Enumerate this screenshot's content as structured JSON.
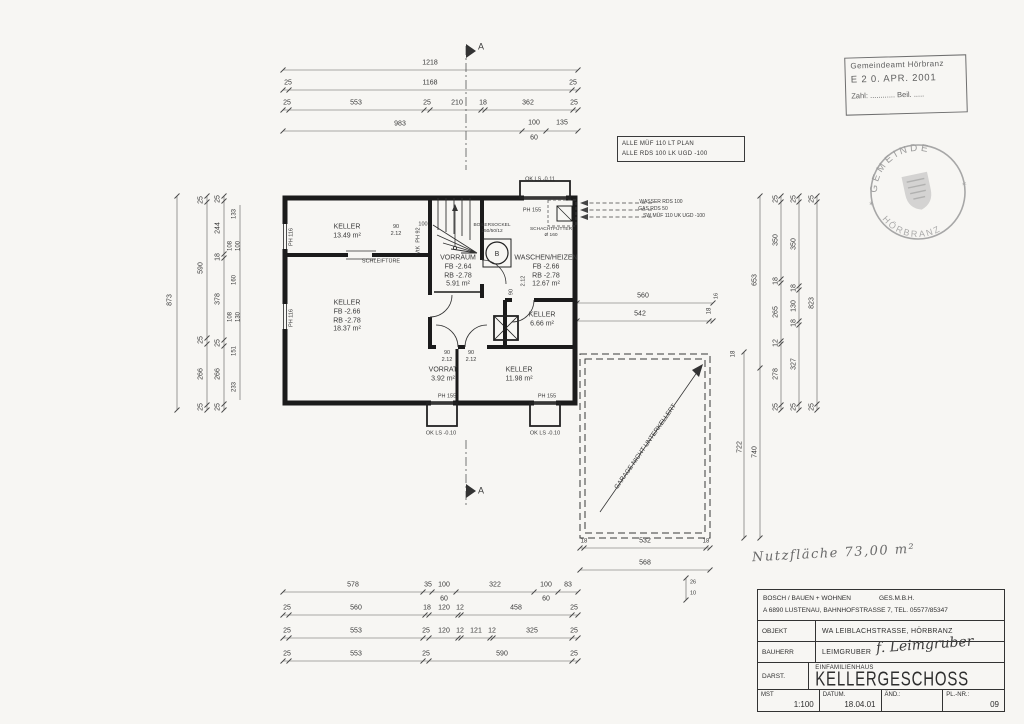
{
  "meta": {
    "paper": "#f7f6f3",
    "ink": "#333333"
  },
  "stamp": {
    "line1": "Gemeindeamt Hörbranz",
    "line2": "E   2 0. APR. 2001",
    "line3": "Zahl: ............  Beil. ....."
  },
  "seal": {
    "top": "GEMEINDE",
    "bottom": "HÖRBRANZ",
    "star_left": "✶",
    "star_right": "✶"
  },
  "note_box": {
    "line1": "ALLE MÜF 110 LT PLAN",
    "line2": "ALLE RDS 100 LK UGD -100"
  },
  "handwriting": {
    "note": "Nutzfläche  73,00 m²"
  },
  "title_block": {
    "company": "BOSCH / BAUEN + WOHNEN",
    "company2": "GES.M.B.H.",
    "address": "A 6890  LUSTENAU, BAHNHOFSTRASSE 7,   TEL. 05577/85347",
    "objekt_label": "OBJEKT",
    "objekt": "WA LEIBLACHSTRASSE, HÖRBRANZ",
    "bauherr_label": "BAUHERR",
    "bauherr": "LEIMGRUBER",
    "signature": "f. Leimgruber",
    "darst_label": "DARST.",
    "darst_small": "EINFAMILIENHAUS",
    "darst_big": "KELLERGESCHOSS",
    "mst_label": "MST",
    "mst": "1:100",
    "datum_label": "DATUM.",
    "datum": "18.04.01",
    "aend_label": "ÄND.:",
    "plnr_label": "PL.-NR.:",
    "plnr": "09"
  },
  "plan": {
    "labels": [
      {
        "t": "1218",
        "x": 430,
        "y": 64
      },
      {
        "t": "25",
        "x": 288,
        "y": 84
      },
      {
        "t": "1168",
        "x": 430,
        "y": 84
      },
      {
        "t": "25",
        "x": 573,
        "y": 84
      },
      {
        "t": "25",
        "x": 287,
        "y": 104
      },
      {
        "t": "553",
        "x": 356,
        "y": 104
      },
      {
        "t": "25",
        "x": 427,
        "y": 104
      },
      {
        "t": "210",
        "x": 457,
        "y": 104
      },
      {
        "t": "18",
        "x": 483,
        "y": 104
      },
      {
        "t": "362",
        "x": 528,
        "y": 104
      },
      {
        "t": "25",
        "x": 574,
        "y": 104
      },
      {
        "t": "983",
        "x": 400,
        "y": 125
      },
      {
        "t": "100",
        "x": 534,
        "y": 124
      },
      {
        "t": "60",
        "x": 534,
        "y": 139
      },
      {
        "t": "135",
        "x": 562,
        "y": 124
      },
      {
        "t": "A",
        "x": 481,
        "y": 47,
        "s": 9,
        "n": "section-marker-a"
      },
      {
        "t": "873",
        "x": 171,
        "y": 300,
        "r": -90
      },
      {
        "t": "25",
        "x": 202,
        "y": 200,
        "r": -90
      },
      {
        "t": "590",
        "x": 202,
        "y": 268,
        "r": -90
      },
      {
        "t": "25",
        "x": 202,
        "y": 340,
        "r": -90
      },
      {
        "t": "266",
        "x": 202,
        "y": 374,
        "r": -90
      },
      {
        "t": "25",
        "x": 202,
        "y": 407,
        "r": -90
      },
      {
        "t": "25",
        "x": 219,
        "y": 199,
        "r": -90
      },
      {
        "t": "244",
        "x": 219,
        "y": 228,
        "r": -90
      },
      {
        "t": "18",
        "x": 219,
        "y": 257,
        "r": -90
      },
      {
        "t": "378",
        "x": 219,
        "y": 299,
        "r": -90
      },
      {
        "t": "25",
        "x": 219,
        "y": 343,
        "r": -90
      },
      {
        "t": "266",
        "x": 219,
        "y": 374,
        "r": -90
      },
      {
        "t": "25",
        "x": 219,
        "y": 407,
        "r": -90
      },
      {
        "t": "133",
        "x": 235,
        "y": 214,
        "r": -90,
        "s": 6
      },
      {
        "t": "108",
        "x": 231,
        "y": 246,
        "r": -90,
        "s": 6
      },
      {
        "t": "100",
        "x": 239,
        "y": 246,
        "r": -90,
        "s": 6
      },
      {
        "t": "160",
        "x": 235,
        "y": 280,
        "r": -90,
        "s": 6
      },
      {
        "t": "108",
        "x": 231,
        "y": 317,
        "r": -90,
        "s": 6
      },
      {
        "t": "130",
        "x": 239,
        "y": 317,
        "r": -90,
        "s": 6
      },
      {
        "t": "151",
        "x": 235,
        "y": 351,
        "r": -90,
        "s": 6
      },
      {
        "t": "233",
        "x": 235,
        "y": 387,
        "r": -90,
        "s": 6
      },
      {
        "t": "653",
        "x": 756,
        "y": 280,
        "r": -90
      },
      {
        "t": "740",
        "x": 756,
        "y": 452,
        "r": -90
      },
      {
        "t": "722",
        "x": 741,
        "y": 447,
        "r": -90
      },
      {
        "t": "25",
        "x": 777,
        "y": 199,
        "r": -90
      },
      {
        "t": "350",
        "x": 777,
        "y": 240,
        "r": -90
      },
      {
        "t": "18",
        "x": 777,
        "y": 281,
        "r": -90
      },
      {
        "t": "265",
        "x": 777,
        "y": 312,
        "r": -90
      },
      {
        "t": "12",
        "x": 777,
        "y": 343,
        "r": -90
      },
      {
        "t": "278",
        "x": 777,
        "y": 374,
        "r": -90
      },
      {
        "t": "25",
        "x": 777,
        "y": 407,
        "r": -90
      },
      {
        "t": "25",
        "x": 795,
        "y": 199,
        "r": -90
      },
      {
        "t": "350",
        "x": 795,
        "y": 244,
        "r": -90
      },
      {
        "t": "18",
        "x": 795,
        "y": 288,
        "r": -90
      },
      {
        "t": "130",
        "x": 795,
        "y": 306,
        "r": -90
      },
      {
        "t": "18",
        "x": 795,
        "y": 323,
        "r": -90
      },
      {
        "t": "327",
        "x": 795,
        "y": 364,
        "r": -90
      },
      {
        "t": "25",
        "x": 795,
        "y": 407,
        "r": -90
      },
      {
        "t": "25",
        "x": 813,
        "y": 199,
        "r": -90
      },
      {
        "t": "823",
        "x": 813,
        "y": 303,
        "r": -90
      },
      {
        "t": "25",
        "x": 813,
        "y": 407,
        "r": -90
      },
      {
        "t": "18",
        "x": 734,
        "y": 354,
        "r": -90,
        "s": 6
      },
      {
        "t": "560",
        "x": 643,
        "y": 297
      },
      {
        "t": "542",
        "x": 640,
        "y": 315
      },
      {
        "t": "18",
        "x": 710,
        "y": 311,
        "r": -90,
        "s": 6
      },
      {
        "t": "16",
        "x": 717,
        "y": 296,
        "r": -90,
        "s": 5.5
      },
      {
        "t": "GARAGE NICHT UNTERKELLERT",
        "x": 646,
        "y": 447,
        "r": -55,
        "s": 6.5,
        "n": "garage-note"
      },
      {
        "t": "18",
        "x": 584,
        "y": 542,
        "s": 6
      },
      {
        "t": "532",
        "x": 645,
        "y": 542
      },
      {
        "t": "18",
        "x": 706,
        "y": 542,
        "s": 6
      },
      {
        "t": "568",
        "x": 645,
        "y": 564
      },
      {
        "t": "26",
        "x": 693,
        "y": 583,
        "s": 5.5
      },
      {
        "t": "10",
        "x": 693,
        "y": 594,
        "s": 5.5
      },
      {
        "t": "578",
        "x": 353,
        "y": 586
      },
      {
        "t": "35",
        "x": 428,
        "y": 586
      },
      {
        "t": "100",
        "x": 444,
        "y": 586
      },
      {
        "t": "60",
        "x": 444,
        "y": 600
      },
      {
        "t": "322",
        "x": 495,
        "y": 586
      },
      {
        "t": "100",
        "x": 546,
        "y": 586
      },
      {
        "t": "60",
        "x": 546,
        "y": 600
      },
      {
        "t": "83",
        "x": 568,
        "y": 586
      },
      {
        "t": "25",
        "x": 287,
        "y": 609
      },
      {
        "t": "560",
        "x": 356,
        "y": 609
      },
      {
        "t": "18",
        "x": 427,
        "y": 609
      },
      {
        "t": "120",
        "x": 444,
        "y": 609
      },
      {
        "t": "12",
        "x": 460,
        "y": 609
      },
      {
        "t": "458",
        "x": 516,
        "y": 609
      },
      {
        "t": "25",
        "x": 574,
        "y": 609
      },
      {
        "t": "25",
        "x": 287,
        "y": 632
      },
      {
        "t": "553",
        "x": 356,
        "y": 632
      },
      {
        "t": "25",
        "x": 426,
        "y": 632
      },
      {
        "t": "120",
        "x": 444,
        "y": 632
      },
      {
        "t": "12",
        "x": 460,
        "y": 632
      },
      {
        "t": "121",
        "x": 476,
        "y": 632
      },
      {
        "t": "12",
        "x": 492,
        "y": 632
      },
      {
        "t": "325",
        "x": 532,
        "y": 632
      },
      {
        "t": "25",
        "x": 574,
        "y": 632
      },
      {
        "t": "25",
        "x": 287,
        "y": 655
      },
      {
        "t": "553",
        "x": 356,
        "y": 655
      },
      {
        "t": "25",
        "x": 426,
        "y": 655
      },
      {
        "t": "590",
        "x": 502,
        "y": 655
      },
      {
        "t": "25",
        "x": 574,
        "y": 655
      },
      {
        "t": "A",
        "x": 481,
        "y": 491,
        "s": 9,
        "n": "section-marker-a"
      },
      {
        "t": "KELLER\n13.49 m²",
        "x": 347,
        "y": 232,
        "s": 7,
        "n": "room-label-keller-1349"
      },
      {
        "t": "KELLER\nFB -2.66\nRB -2.78\n18.37 m²",
        "x": 347,
        "y": 317,
        "s": 7,
        "n": "room-label-keller-1837"
      },
      {
        "t": "VORRAUM\nFB -2.64\nRB -2.78\n5.91 m²",
        "x": 458,
        "y": 272,
        "s": 7,
        "n": "room-label-vorraum"
      },
      {
        "t": "WASCHEN/HEIZEN\nFB -2.66\nRB -2.78\n12.67 m²",
        "x": 546,
        "y": 272,
        "s": 7,
        "n": "room-label-waschen-heizen"
      },
      {
        "t": "KELLER\n6.66 m²",
        "x": 542,
        "y": 320,
        "s": 7,
        "n": "room-label-keller-666"
      },
      {
        "t": "KELLER\n11.98 m²",
        "x": 519,
        "y": 375,
        "s": 7,
        "n": "room-label-keller-1198"
      },
      {
        "t": "VORRAT\n3.92 m²",
        "x": 443,
        "y": 375,
        "s": 7,
        "n": "room-label-vorrat"
      },
      {
        "t": "OK LS -0.11",
        "x": 540,
        "y": 180,
        "s": 5.5
      },
      {
        "t": "PH 155",
        "x": 532,
        "y": 211,
        "s": 5.5
      },
      {
        "t": "PH 155",
        "x": 447,
        "y": 397,
        "s": 5.5
      },
      {
        "t": "PH 155",
        "x": 547,
        "y": 397,
        "s": 5.5
      },
      {
        "t": "OK LS -0.10",
        "x": 441,
        "y": 434,
        "s": 5.5
      },
      {
        "t": "OK LS -0.10",
        "x": 545,
        "y": 434,
        "s": 5.5
      },
      {
        "t": "PH 116",
        "x": 292,
        "y": 237,
        "r": -90,
        "s": 5.5
      },
      {
        "t": "PH 116",
        "x": 292,
        "y": 318,
        "r": -90,
        "s": 5.5
      },
      {
        "t": "VtK  PH 92",
        "x": 419,
        "y": 241,
        "r": -90,
        "s": 5.5
      },
      {
        "t": "SCHLEIFTÜRE",
        "x": 381,
        "y": 262,
        "s": 5.5
      },
      {
        "t": "90\n2.12",
        "x": 396,
        "y": 231,
        "s": 5.5
      },
      {
        "t": "100",
        "x": 423,
        "y": 225,
        "s": 5.5
      },
      {
        "t": "BOILERSOCKEL\n150/50/12",
        "x": 492,
        "y": 229,
        "s": 4.8
      },
      {
        "t": "SCHACHTFUTTER\nØ 160",
        "x": 551,
        "y": 233,
        "s": 4.8
      },
      {
        "t": "2.12",
        "x": 524,
        "y": 281,
        "r": -90,
        "s": 5.5
      },
      {
        "t": "90",
        "x": 512,
        "y": 292,
        "r": -90,
        "s": 5.5
      },
      {
        "t": "90\n2.12",
        "x": 447,
        "y": 357,
        "s": 5.5
      },
      {
        "t": "90\n2.12",
        "x": 471,
        "y": 357,
        "s": 5.5
      },
      {
        "t": "WASSER RDS 100",
        "x": 661,
        "y": 202,
        "s": 5,
        "n": "service-note-wasser"
      },
      {
        "t": "GAS RDS 50",
        "x": 653,
        "y": 209,
        "s": 5,
        "n": "service-note-gas"
      },
      {
        "t": "SW MÜF 110 UK UGD -100",
        "x": 674,
        "y": 216,
        "s": 5,
        "n": "service-note-sw"
      }
    ]
  }
}
